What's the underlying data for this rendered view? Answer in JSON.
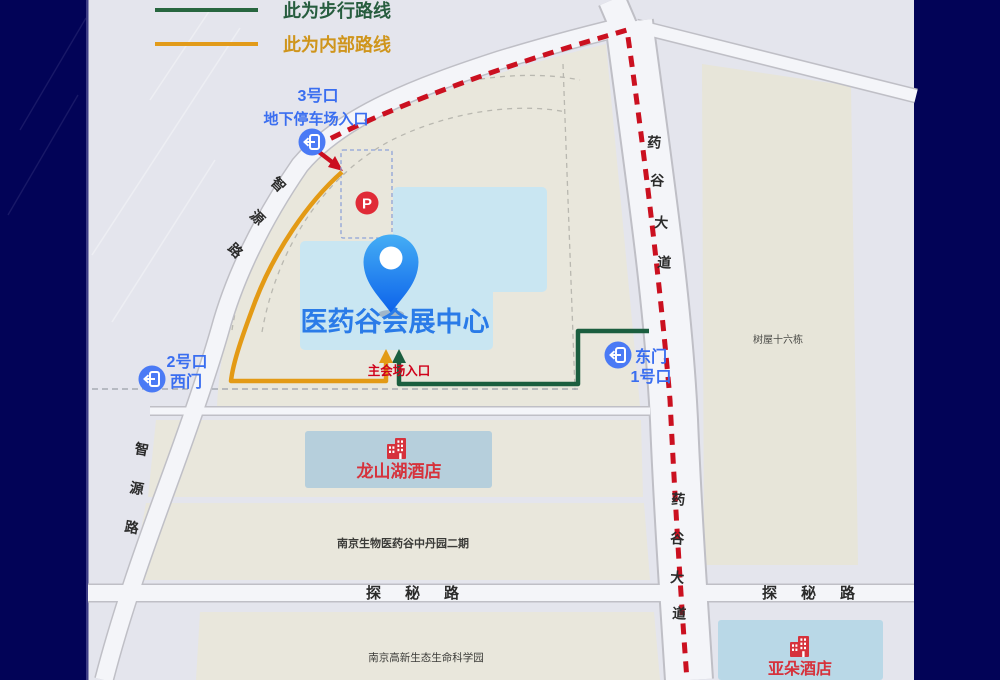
{
  "colors": {
    "background_navy": "#020357",
    "map_background": "#e4e5ed",
    "parcel_beige": "#e9e7dc",
    "road_fill": "#f4f5f9",
    "road_casing": "#bfbfc6",
    "venue_building_blue": "#c9e6f2",
    "hotel_building_blue": "#b6cfdc",
    "atour_building_blue": "#b9d8e7",
    "walk_route_green": "#1b5e3f",
    "internal_route_orange": "#e39a15",
    "drive_route_red": "#cb1020",
    "gate_label_blue": "#3a6ef0",
    "gate_icon_blue": "#4a7af5",
    "venue_title_blue": "#2a7be8",
    "hotel_label_red": "#d6323c",
    "entrance_label_red": "#d0021b",
    "parking_icon_red": "#e02b37",
    "road_label_black": "#2b2b2b",
    "pin_blue": "#1577ed",
    "legend_walk_text": "#275d3f",
    "legend_internal_text": "#cf951c"
  },
  "legend": {
    "walk_label": "此为步行路线",
    "internal_label": "此为内部路线"
  },
  "gates": {
    "gate3_line1": "3号口",
    "gate3_line2": "地下停车场入口",
    "gate2_line1": "2号口",
    "gate2_line2": "西门",
    "east_line1": "东门",
    "east_line2": "1号口",
    "main_entrance": "主会场入口"
  },
  "venue": {
    "title": "医药谷会展中心",
    "parking_label": "P"
  },
  "places": {
    "longshan_hotel": "龙山湖酒店",
    "atour_hotel": "亚朵酒店",
    "treehouse": "树屋十六栋",
    "zhongdan_park": "南京生物医药谷中丹园二期",
    "lifescience_park": "南京高新生态生命科学园"
  },
  "roads": {
    "zhiyuan": "智源路",
    "yaogu": "药谷大道",
    "tanmi": "探秘路"
  }
}
